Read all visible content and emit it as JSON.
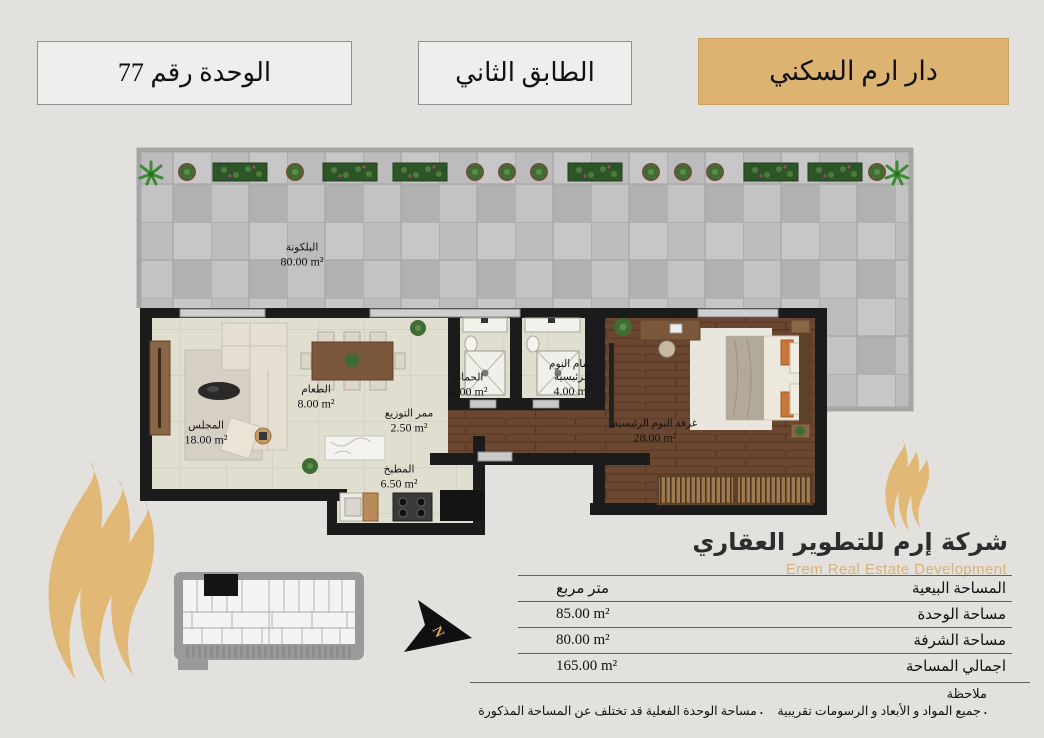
{
  "colors": {
    "accent": "#dcb371",
    "gold_logo": "#e2b877",
    "wall": "#1b1b1b",
    "company_en_text": "#d8b279"
  },
  "header": {
    "project": "دار ارم السكني",
    "floor": "الطابق الثاني",
    "unit": "الوحدة رقم 77"
  },
  "plan": {
    "north": "N",
    "rooms": [
      {
        "name": "البلكونة",
        "area": "80.00 m²"
      },
      {
        "name": "المجلس",
        "area": "18.00 m²"
      },
      {
        "name": "الطعام",
        "area": "8.00 m²"
      },
      {
        "name": "ممر التوزيع",
        "area": "2.50 m²"
      },
      {
        "name": "الحمام",
        "area": "4.00 m²"
      },
      {
        "name": "حمام النوم الرئيسية",
        "area": "4.00 m²"
      },
      {
        "name": "غرفة النوم الرئيسية",
        "area": "28.00 m²"
      },
      {
        "name": "المطبخ",
        "area": "6.50 m²"
      }
    ]
  },
  "company": {
    "name_ar": "شركة إرم للتطوير العقاري",
    "name_en": "Erem Real Estate Development"
  },
  "area_table": {
    "header_label": "المساحة البيعية",
    "header_value": "متر مربع",
    "rows": [
      {
        "label": "مساحة الوحدة",
        "value": "85.00 m²"
      },
      {
        "label": "مساحة الشرفة",
        "value": "80.00 m²"
      },
      {
        "label": "اجمالي المساحة",
        "value": "165.00 m²"
      }
    ]
  },
  "notes": {
    "title": "ملاحظة",
    "bullet": ".",
    "items": [
      "جميع المواد و الأبعاد و الرسومات تقريبية",
      "مساحة الوحدة الفعلية قد تختلف عن المساحة المذكورة"
    ]
  }
}
